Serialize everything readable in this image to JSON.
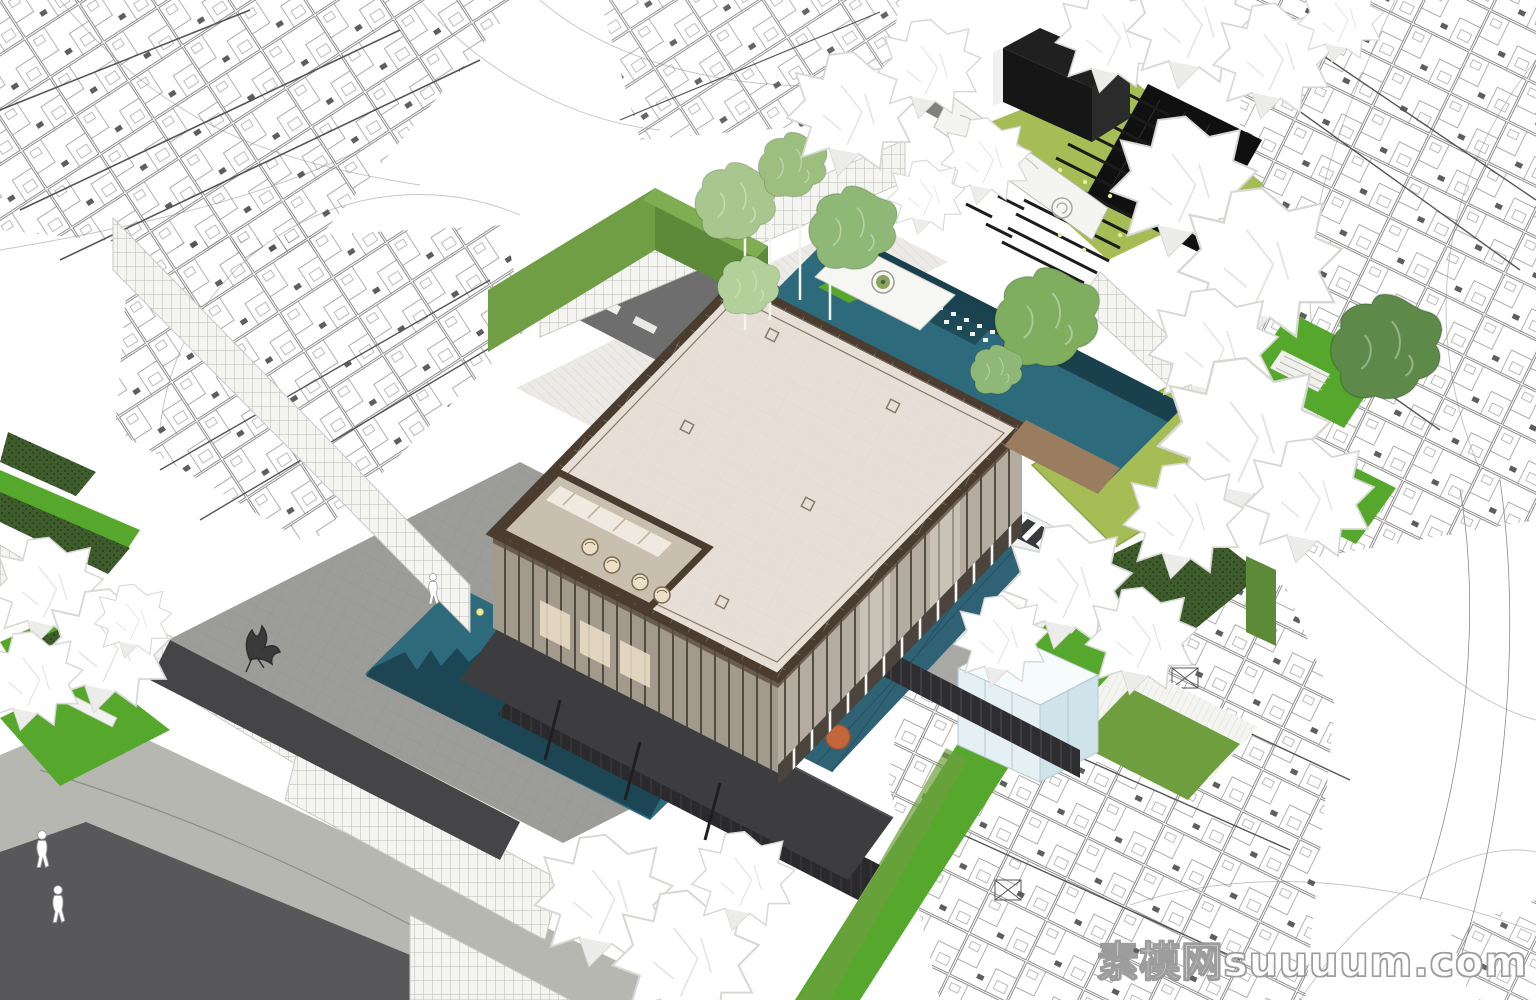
{
  "watermark": {
    "text": "素模网suuuum.com"
  },
  "palette": {
    "paper": "#ffffff",
    "contour_line": "#c6c6c6",
    "plan_line": "#8a8a8a",
    "plan_dark": "#555555",
    "roof_cream": "#e7dfd6",
    "roof_trim": "#4a3c2f",
    "roof_inner": "#8a7868",
    "roof_grid": "#dcd3c9",
    "glass_sw": "#a39a8e",
    "glass_se": "#b4aca0",
    "mullion": "#3c352b",
    "glow": "#ecdfc8",
    "notch_floor": "#c9bfae",
    "pool_teal": "#2d6a7c",
    "pool_deep": "#1c4350",
    "pool_reflect": "#173c48",
    "pool_lap": "#2f6275",
    "lawn_bright": "#55a82c",
    "lawn_mid": "#6f9e3f",
    "lawn_olive": "#a6bd55",
    "hedge_dark": "#3f5c2c",
    "hedge_dot": "#2c441e",
    "wall_green": "#6f9e44",
    "wall_green_dark": "#5d8a38",
    "plaza_gray": "#9c9c98",
    "plaza_line": "#90908c",
    "path_gray": "#a8a8a4",
    "courtyard_gray": "#6e6e6e",
    "road_light": "#b7b7b2",
    "road_dark": "#58585a",
    "charcoal": "#3d3d3f",
    "charcoal_deep": "#2a2a2c",
    "black_box": "#161616",
    "fence_dark": "#2e2e30",
    "fence_slat": "#4a4a4e",
    "white_wall": "#f4f4f1",
    "grid_line": "#b9b9b4",
    "step_line": "#d6d4ce",
    "step_line2": "#dedcd6",
    "cube_face": "#e4f0f4",
    "cube_side": "#cfe3ea",
    "cube_top": "#f6fbfc",
    "island_white": "#f6f6f3",
    "wood": "#9a7d5e",
    "tree_white_edge": "#d7d7d4",
    "tree_green": "#9cc27c",
    "tree_green_dark": "#7fae5f",
    "tree_green_deep": "#5d8a48",
    "orange": "#c2663c",
    "dot_yellow": "#e8eb9a",
    "bench_black": "#1b1b1b",
    "watermark": "#ffffff",
    "watermark_outline": "#9a9a9a"
  }
}
